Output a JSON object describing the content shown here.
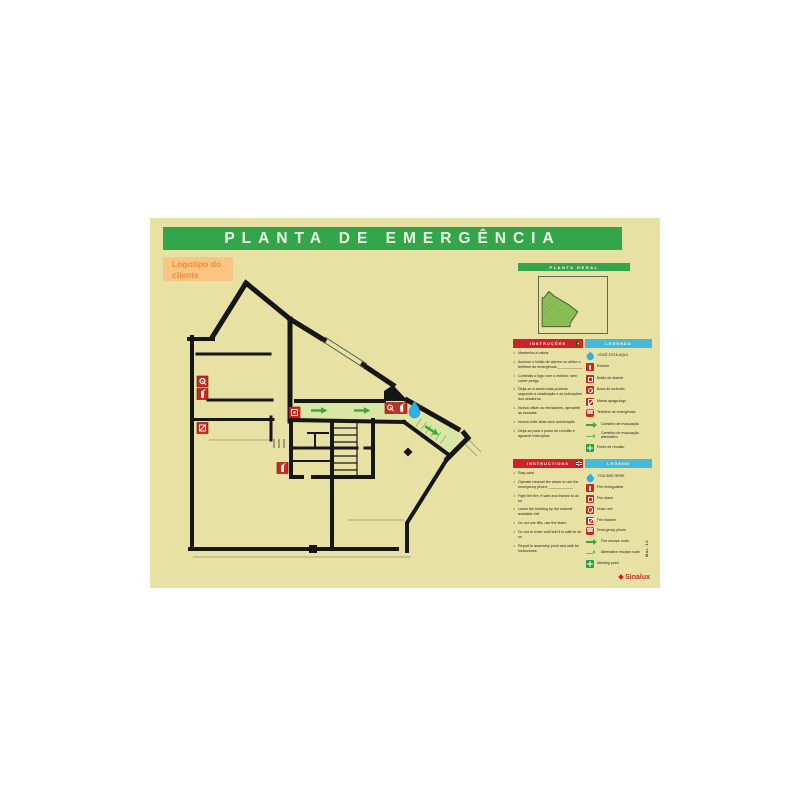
{
  "title": "PLANTA DE EMERGÊNCIA",
  "logo_placeholder": "Logotipo do cliente",
  "general_plan": {
    "header": "PLANTA GERAL"
  },
  "sections": {
    "pt": {
      "instructions_header": "INSTRUÇÕES",
      "legend_header": "LEGENDA",
      "instructions": [
        "Mantenha a calma",
        "Accione o botão de alarme ou utilize o telefone de emergência ____________",
        "Combata o fogo com o extintor, sem correr perigo",
        "Dirija-se à saída mais próxima seguindo a sinalização e as indicações dos sinaleiros",
        "Nunca utilize os elevadores, aproveite as escadas",
        "Nunca volte atrás sem autorização",
        "Dirija-se para o ponto de reunião e aguarde instruções"
      ],
      "legend": [
        "VOCÊ ESTÁ AQUI",
        "Extintor",
        "Botão de alarme",
        "Boca de incêndio",
        "Manta apaga-fogo",
        "Telefone de emergência",
        "Caminho de evacuação",
        "Caminho de evacuação alternativo",
        "Ponto de reunião"
      ]
    },
    "en": {
      "instructions_header": "INSTRUCTIONS",
      "legend_header": "LEGEND",
      "instructions": [
        "Stay calm",
        "Operate nearest fire alarm or use the emergency phone ____________",
        "Fight the fire, if safe and trained to do so",
        "Leave the building by the nearest available exit",
        "Do not use lifts, use the stairs",
        "Do not re-enter until told it is safe to do so",
        "Report to assembly point and wait for instructions"
      ],
      "legend": [
        "YOU ARE HERE",
        "Fire extinguisher",
        "Fire alarm",
        "Hose reel",
        "Fire blanket",
        "Emergency phone",
        "Fire escape route",
        "Alternative escape route",
        "Meeting point"
      ]
    }
  },
  "legend_icons": [
    "you-are-here-drop-icon",
    "fire-extinguisher-icon",
    "fire-alarm-button-icon",
    "hose-reel-icon",
    "fire-blanket-icon",
    "emergency-phone-icon",
    "escape-route-arrow-icon",
    "alternative-escape-route-arrow-icon",
    "meeting-point-icon"
  ],
  "footer": {
    "brand": "Sinalux",
    "edition": "Mar. 12"
  },
  "colors": {
    "poster_bg": "#e7e2a4",
    "signal_green": "#33a64c",
    "arrow_green": "#3aaa35",
    "signal_red": "#cf2127",
    "legend_blue": "#44b9da",
    "drop_blue": "#2bb0e8",
    "logo_bg": "#fac483",
    "logo_text": "#ef8e35",
    "wall_black": "#161616",
    "route_fill": "#d9e6a6"
  }
}
